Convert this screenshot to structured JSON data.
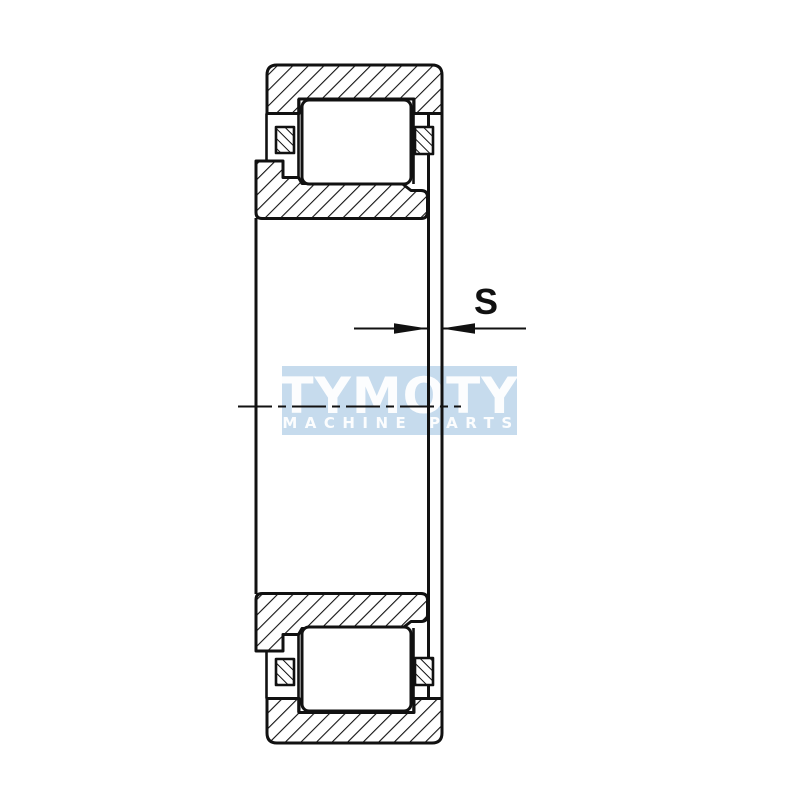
{
  "dimension": {
    "label": "S"
  },
  "watermark": {
    "brand": "TYMOTY",
    "tagline": "MACHINE PARTS",
    "bg_color": "#c6dbed",
    "text_color": "#ffffff"
  },
  "drawing": {
    "line_color": "#111111",
    "background_color": "#ffffff"
  }
}
